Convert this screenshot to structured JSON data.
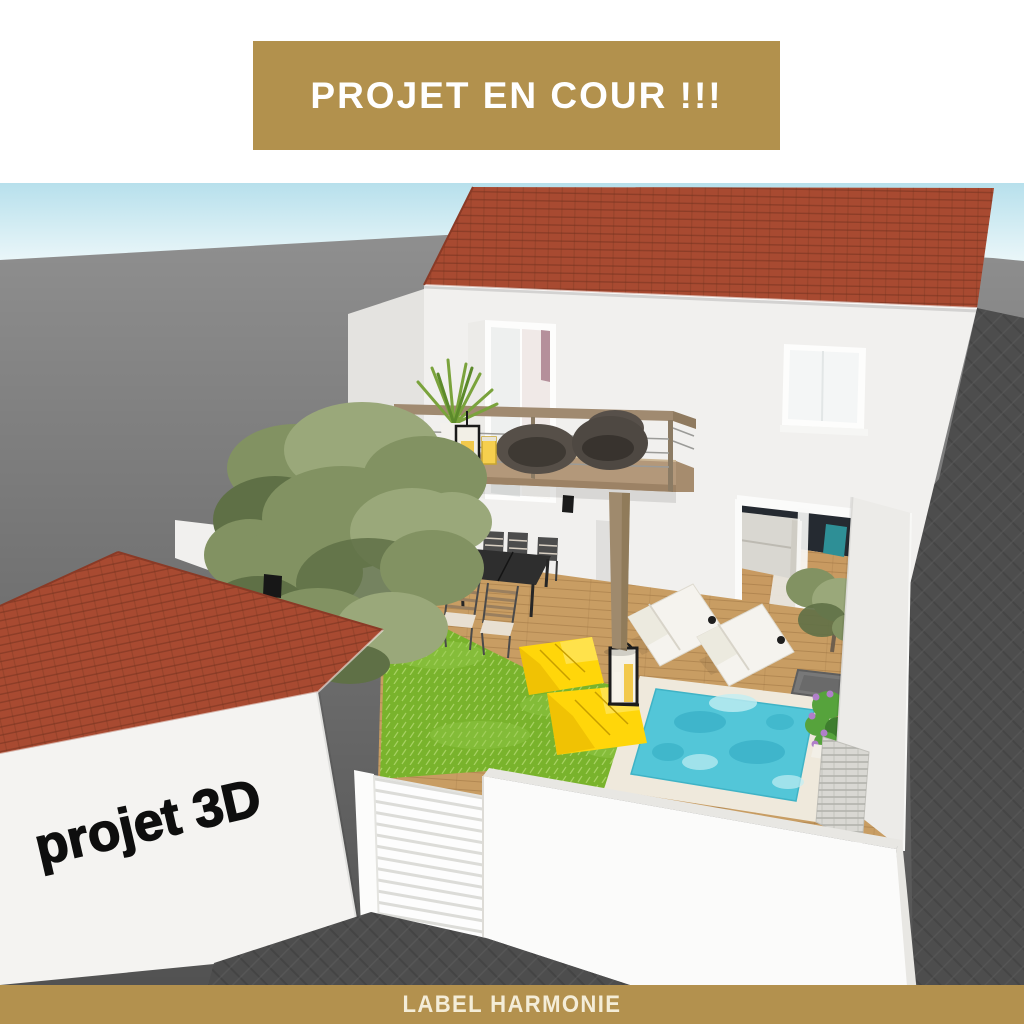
{
  "top_banner": {
    "text": "PROJET EN COUR !!!",
    "bg_color": "#b2914d",
    "text_color": "#ffffff"
  },
  "watermark": {
    "text": "projet 3D",
    "color": "#0e0e0e",
    "rotation_deg": -13
  },
  "bottom_bar": {
    "text": "LABEL HARMONIE",
    "bg_color": "#b3914e",
    "text_color": "#f4edd8"
  },
  "scene": {
    "description": "3D architectural rendering (aerial view) of a two-storey white house with red tile roof, wooden balcony, terrace, lawn, plunge pool and walled courtyard, with a red-roofed annex building in the foreground.",
    "objects": [
      "two-storey house with red tile roof",
      "wooden balcony with two rattan chairs, yucca plant and candle lanterns",
      "upper-floor window and open bedroom door",
      "open sliding glass door showing living room with grey sofa and teal chair",
      "wooden deck terrace",
      "black outdoor dining table with slatted chairs",
      "green lawn with two yellow bean-bag cushions and a floor lantern",
      "two white sun loungers",
      "square turquoise plunge pool with pale surround",
      "olive tree and shrubs",
      "flowering plant with purple blooms near pool",
      "single-storey annex building with red hip roof",
      "white slatted garden gate",
      "white boundary and street walls",
      "dark grey herringbone paved street",
      "blue sky band at horizon"
    ],
    "colors": {
      "gold": "#b2914d",
      "sky_top": "#b7e0ec",
      "ground_far": "#8f8f8f",
      "paving_dark": "#4d4d4d",
      "roof_red": "#a84a31",
      "wall_main": "#f1f0ee",
      "wall_shade": "#e4e3e0",
      "wall_bright": "#fbfbfa",
      "deck_wood": "#c89d63",
      "interior_wood": "#c89a61",
      "lawn_green": "#79b32c",
      "lawn_light": "#94ca4b",
      "pool_water": "#53c6d8",
      "pool_rim": "#efe9dc",
      "pouf_yellow": "#ffd60a",
      "lounger_white": "#f5f3ee",
      "gate_white": "#fdfdfd",
      "table_black": "#2e2e2e",
      "chair_teal": "#2e8f96",
      "sofa_grey": "#d9d7d1",
      "interior_dark": "#252a31",
      "rail_wood": "#a08a70",
      "post_wood": "#9f8a6d",
      "candle_yellow": "#f2c94c",
      "tree_olive": "#829262",
      "tree_dark": "#5f7046",
      "tree_light": "#9aa87a",
      "flower_purple": "#b07fc9",
      "plant_green": "#56a33c"
    }
  }
}
